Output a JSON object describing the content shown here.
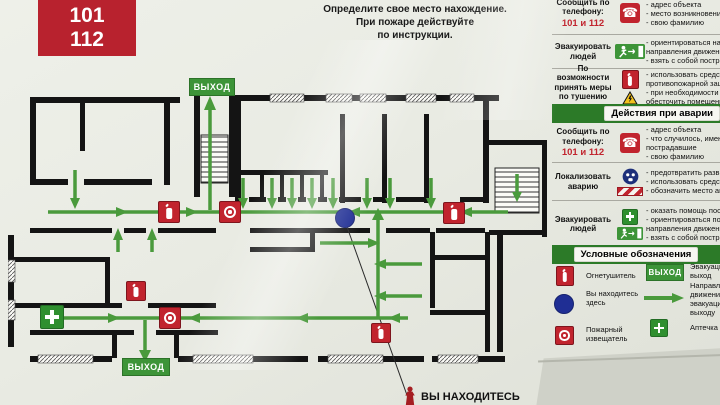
{
  "call_box": {
    "title": "ЗВОНИТЬ",
    "numbers": [
      "101",
      "112"
    ]
  },
  "top_instruction": {
    "lines": [
      "Определите свое место нахождение.",
      "При пожаре действуйте",
      "по инструкции."
    ]
  },
  "signs": {
    "exit": "ВЫХОД"
  },
  "you_are_here_label": "ВЫ НАХОДИТЕСЬ",
  "fire_actions": {
    "rows": [
      {
        "label": "Сообщить по телефону:",
        "phone": "101 и 112",
        "icon": "phone-icon",
        "bullets": [
          "- адрес объекта",
          "- место возникновения",
          "- свою фамилию"
        ]
      },
      {
        "label": "Эвакуировать людей",
        "icon": "exit-run-icon",
        "bullets": [
          "- ориентироваться на знаки",
          "направления движения",
          "- взять с собой пострадавших"
        ]
      },
      {
        "label": "По возможности принять меры по тушению пожара",
        "icon": "extinguisher-icon electric-hazard-icon",
        "bullets": [
          "- использовать средства",
          "противопожарной защиты",
          "- при необходимости",
          "обесточить помещение"
        ]
      }
    ]
  },
  "emergency_actions": {
    "header": "Действия при аварии",
    "rows": [
      {
        "label": "Сообщить по телефону:",
        "phone": "101 и 112",
        "icon": "phone-icon",
        "bullets": [
          "- адрес объекта",
          "- что случилось, имеются ли",
          "пострадавшие",
          "- свою фамилию"
        ]
      },
      {
        "label": "Локализовать аварию",
        "icon": "gas-mask-icon barrier-tape-icon",
        "bullets": [
          "- предотвратить развитие",
          "- использовать средства",
          "- обозначить место аварии"
        ]
      },
      {
        "label": "Эвакуировать людей",
        "icon": "first-aid-icon exit-run-icon",
        "bullets": [
          "- оказать помощь пострадавшим",
          "- ориентироваться по знакам",
          "направления движения",
          "- взять с собой пострадавших"
        ]
      }
    ]
  },
  "legend": {
    "header": "Условные обозначения",
    "items": [
      {
        "icon": "extinguisher-icon",
        "label": "Огнетушитель"
      },
      {
        "icon": "you-are-here-dot",
        "label": "Вы находитесь здесь"
      },
      {
        "icon": "fire-detector-icon",
        "label": "Пожарный извещатель"
      },
      {
        "icon": "exit-sign",
        "label": "Эвакуационный выход"
      },
      {
        "icon": "direction-arrow",
        "label": "Направление движения к эвакуационному выходу"
      },
      {
        "icon": "first-aid-icon",
        "label": "Аптечка"
      }
    ]
  },
  "icons": {
    "phone_glyph": "☎"
  },
  "colors": {
    "accent_red": "#c1242e",
    "sign_green": "#3d9438",
    "route_green": "#4a9a3c",
    "header_green": "#2c7a28",
    "you_are_here_blue": "#1f2e94",
    "wall_black": "#141414"
  }
}
